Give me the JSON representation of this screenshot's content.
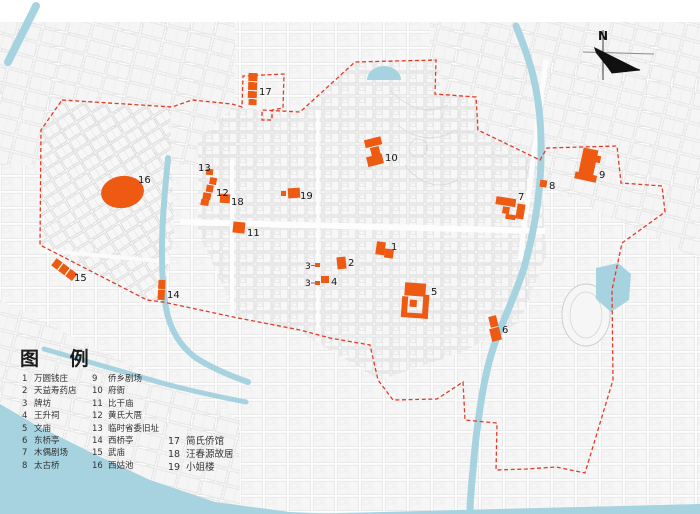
{
  "colors": {
    "accent_orange": "#ee5a12",
    "water": "#a7d3e0",
    "boundary_red": "#e23b28"
  },
  "compass": {
    "label": "N"
  },
  "legend": {
    "title": "图 例",
    "col1": [
      {
        "num": "1",
        "label": "万圆钱庄"
      },
      {
        "num": "2",
        "label": "天益寿药店"
      },
      {
        "num": "3",
        "label": "牌坊"
      },
      {
        "num": "4",
        "label": "王升祠"
      },
      {
        "num": "5",
        "label": "文庙"
      },
      {
        "num": "6",
        "label": "东桥亭"
      },
      {
        "num": "7",
        "label": "木偶剧场"
      },
      {
        "num": "8",
        "label": "太古桥"
      }
    ],
    "col2": [
      {
        "num": "9",
        "label": "侨乡剧场"
      },
      {
        "num": "10",
        "label": "府衙"
      },
      {
        "num": "11",
        "label": "比干庙"
      },
      {
        "num": "12",
        "label": "黄氏大厝"
      },
      {
        "num": "13",
        "label": "临时省委旧址"
      },
      {
        "num": "14",
        "label": "西桥亭"
      },
      {
        "num": "15",
        "label": "武庙"
      },
      {
        "num": "16",
        "label": "西姑池"
      }
    ],
    "col3": [
      {
        "num": "17",
        "label": "简氏侨馆"
      },
      {
        "num": "18",
        "label": "汪春源故居"
      },
      {
        "num": "19",
        "label": "小姐楼"
      }
    ]
  },
  "map_labels": [
    "1",
    "2",
    "3",
    "3",
    "4",
    "5",
    "6",
    "7",
    "8",
    "9",
    "10",
    "11",
    "12",
    "13",
    "14",
    "15",
    "16",
    "17",
    "18",
    "19"
  ]
}
